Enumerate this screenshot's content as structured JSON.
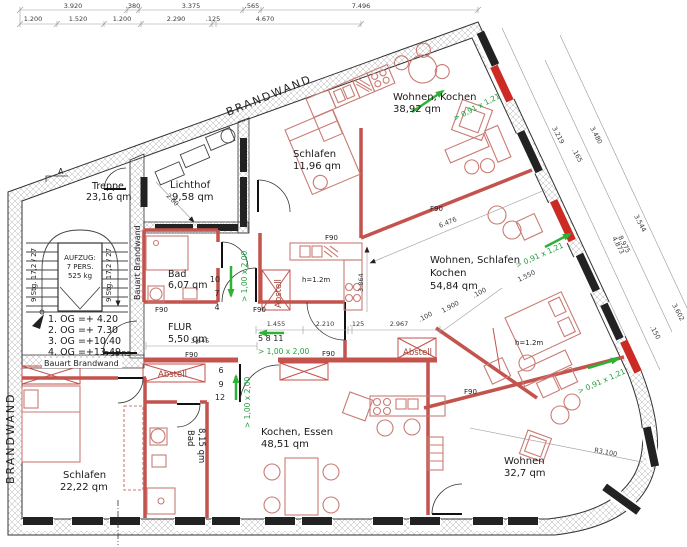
{
  "walls": {
    "brandwand_top": "BRANDWAND",
    "brandwand_left": "BRANDWAND",
    "bauart_vertical": "Bauart Brandwand",
    "bauart_horizontal": "Bauart Brandwand",
    "fire_rating": "F90",
    "door_rating": "T 30 RS",
    "radius": "R3.100"
  },
  "rooms": {
    "treppe": {
      "name": "Treppe,",
      "area": "23,16 qm"
    },
    "lichthof": {
      "name": "Lichthof",
      "area": "9,58 qm"
    },
    "schlafen_top": {
      "name": "Schlafen",
      "area": "11,96 qm"
    },
    "wohnen_kochen": {
      "name": "Wohnen, Kochen",
      "area": "38,92 qm"
    },
    "bad_top": {
      "name": "Bad",
      "area": "6,07 qm"
    },
    "flur": {
      "name": "FLUR",
      "area": "5,50 qm"
    },
    "wohnen_schlafen_kochen": {
      "name1": "Wohnen, Schlafen",
      "name2": "Kochen",
      "area": "54,84 qm"
    },
    "schlafen_bottom": {
      "name": "Schlafen",
      "area": "22,22 qm"
    },
    "bad_bottom": {
      "name": "Bad",
      "area": "8,15 qm"
    },
    "kochen_essen": {
      "name": "Kochen, Essen",
      "area": "48,51 qm"
    },
    "wohnen_bottom": {
      "name": "Wohnen",
      "area": "32,7 qm"
    },
    "abstell": "Abstell"
  },
  "stair": {
    "flight_label": "9 Stg. 17,2 / 27",
    "elevator": [
      "AUFZUG:",
      "7 PERS.",
      "525 kg"
    ],
    "section_marker": "A"
  },
  "levels": [
    "1. OG =+  4.20",
    "2. OG =+  7.30",
    "3. OG =+10.40",
    "4. OG =+13.49"
  ],
  "escape": {
    "door_size": "> 1,00 x 2,00",
    "window_size": "> 0,91 x 1,21"
  },
  "door_numbers": {
    "top": [
      "10",
      "7",
      "4"
    ],
    "right": "5  8  11",
    "bottom": [
      "6",
      "9",
      "12"
    ]
  },
  "annotations": {
    "parapet": "h=1.2m"
  },
  "dimensions": {
    "top_row1": [
      "3.920",
      ".380",
      "3.375",
      ".565",
      "7.496"
    ],
    "top_row2": [
      "1.200",
      "1.520",
      "1.200",
      "2.290",
      ".125",
      "4.670"
    ],
    "right_outer": [
      "3.219",
      "4.873"
    ],
    "right_mid": [
      ".165",
      "3.480"
    ],
    "right_inner": [
      "8.975",
      "3.544",
      "1.550"
    ],
    "right_lower": [
      ".150",
      "3.602"
    ],
    "mid_row": [
      "2.210",
      ".125",
      "2.967",
      ".100",
      "1.900",
      ".100"
    ],
    "flur_width": "3.645",
    "door_right": "1.455",
    "room_diag": "6.476",
    "room_height": "3.864",
    "lichthof_diag": "2.00"
  },
  "colors": {
    "wall_red": "#c4524d",
    "escape_green": "#1f9e3e",
    "window_red": "#cc2b24",
    "hatch_gray": "#b3b3b3"
  }
}
